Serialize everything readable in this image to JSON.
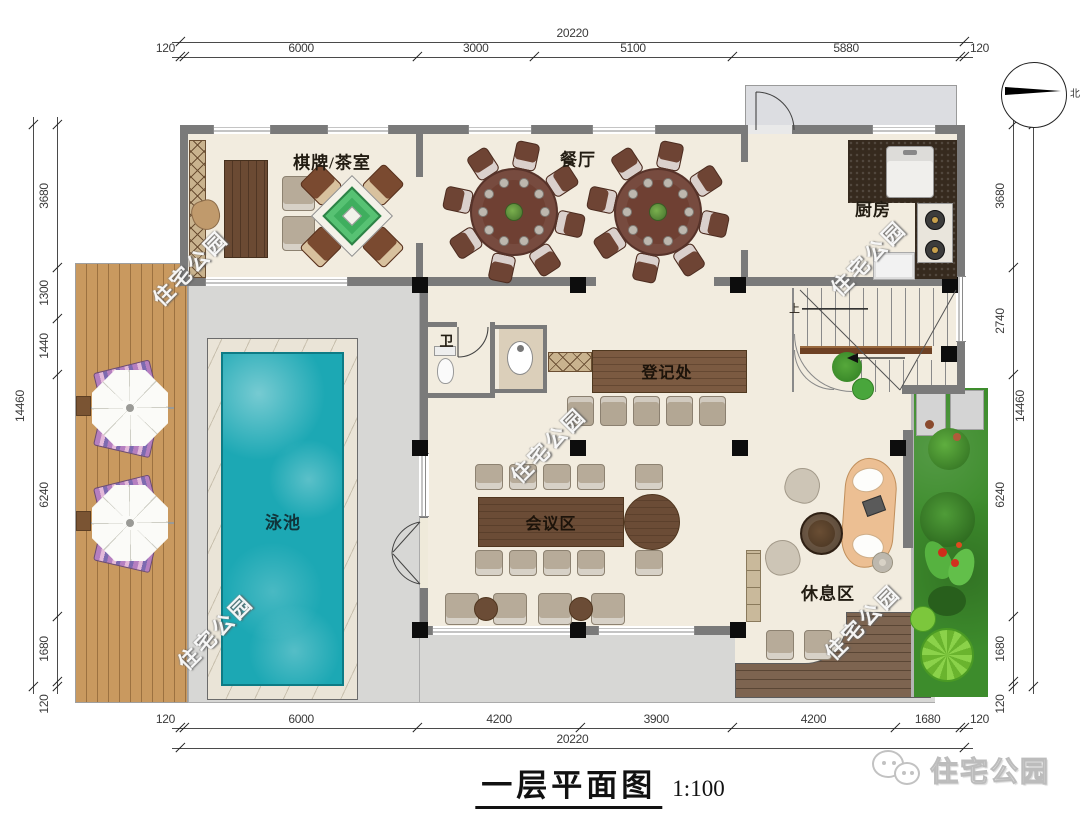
{
  "title": {
    "text": "一层平面图",
    "scale": "1:100"
  },
  "compass": {
    "label": "北"
  },
  "logo": {
    "text": "住宅公园"
  },
  "watermark": {
    "text": "住宅公园"
  },
  "rooms": {
    "chess_tea": "棋牌/茶室",
    "dining": "餐厅",
    "kitchen": "厨房",
    "wc": "卫",
    "registration": "登记处",
    "meeting": "会议区",
    "lounge": "休息区",
    "pool": "泳池",
    "stairs_up": "上"
  },
  "dimensions": {
    "top": {
      "overall": "20220",
      "segments": [
        "120",
        "6000",
        "3000",
        "5100",
        "5880",
        "120"
      ]
    },
    "bottom": {
      "overall": "20220",
      "segments": [
        "120",
        "6000",
        "4200",
        "3900",
        "4200",
        "1680",
        "120"
      ]
    },
    "left": {
      "overall": "14460",
      "segments": [
        "3680",
        "1300",
        "1440",
        "6240",
        "1680",
        "120"
      ]
    },
    "right": {
      "overall": "14460",
      "segments": [
        "3680",
        "2740",
        "6240",
        "1680",
        "120"
      ]
    }
  },
  "colors": {
    "wall": "#7a7a7a",
    "column": "#0d0d0d",
    "floor": "#f2ecdf",
    "patio": "#d7d7d5",
    "deck_wood": "#c9995f",
    "lounge_deck": "#7d6450",
    "pool_water": "#1ca8b4",
    "garden": "#3d8c2c",
    "counter_wood": "#7b5a41",
    "dim_text": "#333333"
  }
}
